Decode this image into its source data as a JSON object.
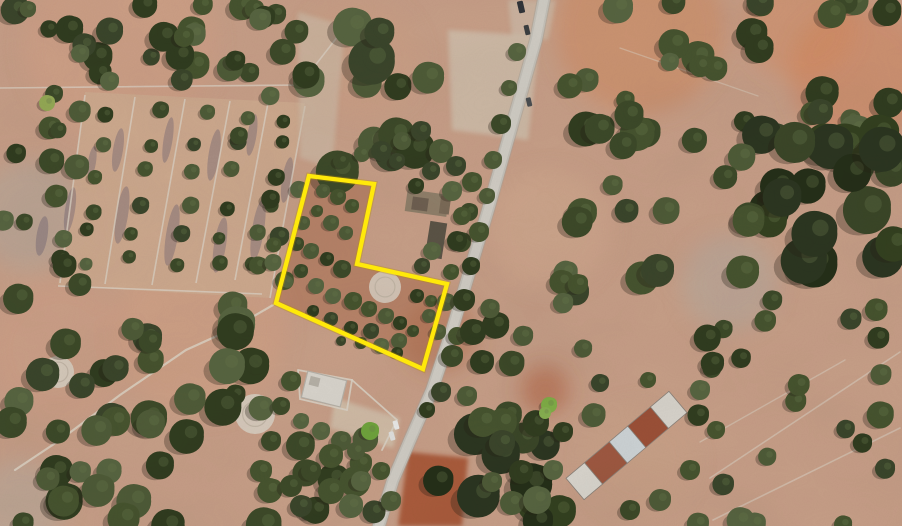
{
  "canvas": {
    "width": 902,
    "height": 526
  },
  "background": {
    "base": "#c79e87"
  },
  "seed": 1337,
  "noise": {
    "grain_opacity": 0.08,
    "mottle_opacity": 0.12
  },
  "soft_patches": [
    {
      "x": 640,
      "y": 30,
      "r": 85,
      "color": "#d08457",
      "opacity": 0.45
    },
    {
      "x": 860,
      "y": 75,
      "r": 70,
      "color": "#d2825a",
      "opacity": 0.5
    },
    {
      "x": 800,
      "y": 25,
      "r": 55,
      "color": "#d68a5e",
      "opacity": 0.45
    },
    {
      "x": 120,
      "y": 45,
      "r": 95,
      "color": "#d6a184",
      "opacity": 0.4
    },
    {
      "x": 200,
      "y": 330,
      "r": 85,
      "color": "#d8a183",
      "opacity": 0.4
    },
    {
      "x": 60,
      "y": 350,
      "r": 70,
      "color": "#d3a088",
      "opacity": 0.35
    },
    {
      "x": 30,
      "y": 215,
      "r": 55,
      "color": "#b0a79d",
      "opacity": 0.5
    },
    {
      "x": 730,
      "y": 283,
      "r": 48,
      "color": "#b3a89d",
      "opacity": 0.55
    },
    {
      "x": 550,
      "y": 230,
      "r": 60,
      "color": "#d3ac90",
      "opacity": 0.35
    },
    {
      "x": 440,
      "y": 335,
      "r": 38,
      "color": "#a9623f",
      "opacity": 0.4
    },
    {
      "x": 545,
      "y": 390,
      "r": 24,
      "color": "#b05a36",
      "opacity": 0.5
    },
    {
      "x": 20,
      "y": 505,
      "r": 45,
      "color": "#b4a99e",
      "opacity": 0.5
    },
    {
      "x": 640,
      "y": 460,
      "r": 55,
      "color": "#c9a184",
      "opacity": 0.4
    },
    {
      "x": 360,
      "y": 60,
      "r": 60,
      "color": "#cfa183",
      "opacity": 0.35
    }
  ],
  "flat_patches": [
    {
      "points": [
        [
          448,
          30
        ],
        [
          540,
          36
        ],
        [
          528,
          140
        ],
        [
          452,
          130
        ]
      ],
      "color": "#cfc0ad",
      "opacity": 0.75
    },
    {
      "points": [
        [
          298,
          12
        ],
        [
          345,
          26
        ],
        [
          332,
          168
        ],
        [
          300,
          158
        ]
      ],
      "color": "#ccbda9",
      "opacity": 0.6
    },
    {
      "points": [
        [
          408,
          452
        ],
        [
          468,
          458
        ],
        [
          462,
          526
        ],
        [
          398,
          526
        ]
      ],
      "color": "#a34f30",
      "opacity": 0.85
    },
    {
      "points": [
        [
          335,
          398
        ],
        [
          400,
          418
        ],
        [
          393,
          448
        ],
        [
          330,
          428
        ]
      ],
      "color": "#d2c2ad",
      "opacity": 0.8
    },
    {
      "points": [
        [
          508,
          0
        ],
        [
          556,
          0
        ],
        [
          548,
          40
        ],
        [
          512,
          36
        ]
      ],
      "color": "#cdbfae",
      "opacity": 0.6
    }
  ],
  "fields": {
    "quad": [
      [
        85,
        92
      ],
      [
        305,
        103
      ],
      [
        270,
        298
      ],
      [
        58,
        286
      ]
    ],
    "fill": "#cda98e",
    "fill_opacity": 0.9,
    "wall_color": "#dbd2c4",
    "wall_width": 1.6,
    "wall_opacity": 0.75,
    "walls": [
      [
        [
          85,
          95
        ],
        [
          60,
          283
        ]
      ],
      [
        [
          135,
          97
        ],
        [
          105,
          284
        ]
      ],
      [
        [
          185,
          99
        ],
        [
          152,
          285
        ]
      ],
      [
        [
          230,
          101
        ],
        [
          196,
          283
        ]
      ],
      [
        [
          268,
          103
        ],
        [
          235,
          280
        ]
      ],
      [
        [
          305,
          106
        ],
        [
          270,
          298
        ]
      ],
      [
        [
          58,
          286
        ],
        [
          262,
          294
        ]
      ]
    ],
    "streak_color": "#57506a",
    "streak_opacity": 0.32,
    "streak_angle": 9,
    "streaks": [
      [
        118,
        150,
        10,
        44
      ],
      [
        122,
        215,
        12,
        58
      ],
      [
        168,
        140,
        9,
        46
      ],
      [
        172,
        235,
        12,
        62
      ],
      [
        214,
        155,
        11,
        52
      ],
      [
        220,
        245,
        12,
        56
      ],
      [
        252,
        135,
        9,
        42
      ],
      [
        258,
        230,
        12,
        62
      ],
      [
        287,
        180,
        10,
        46
      ],
      [
        70,
        210,
        10,
        46
      ],
      [
        42,
        236,
        11,
        40
      ],
      [
        92,
        162,
        8,
        32
      ]
    ],
    "tree_rows": {
      "x_top": [
        110,
        160,
        207,
        249,
        287
      ],
      "x_bot": [
        82,
        128,
        174,
        215,
        253
      ],
      "y_top": 102,
      "y_bot": 278,
      "per_row": 6,
      "r_min": 6,
      "r_max": 9
    }
  },
  "lines": [
    {
      "points": [
        [
          0,
          88
        ],
        [
          300,
          85
        ],
        [
          345,
          27
        ]
      ],
      "color": "#dbd2c4",
      "width": 1.6,
      "opacity": 0.7
    },
    {
      "points": [
        [
          273,
          305
        ],
        [
          230,
          330
        ],
        [
          186,
          350
        ],
        [
          120,
          395
        ],
        [
          60,
          440
        ],
        [
          15,
          470
        ]
      ],
      "color": "#ddd4c6",
      "width": 2.2,
      "opacity": 0.8
    },
    {
      "points": [
        [
          532,
          36
        ],
        [
          505,
          150
        ],
        [
          480,
          240
        ],
        [
          455,
          330
        ],
        [
          437,
          380
        ]
      ],
      "color": "#eae4d8",
      "width": 1.8,
      "opacity": 0.7
    },
    {
      "points": [
        [
          710,
          478
        ],
        [
          900,
          352
        ]
      ],
      "color": "#d7ccbc",
      "width": 1.6,
      "opacity": 0.6
    },
    {
      "points": [
        [
          700,
          442
        ],
        [
          845,
          360
        ]
      ],
      "color": "#d7ccbc",
      "width": 1.4,
      "opacity": 0.55
    },
    {
      "points": [
        [
          713,
          520
        ],
        [
          900,
          428
        ]
      ],
      "color": "#d7ccbc",
      "width": 1.6,
      "opacity": 0.6
    },
    {
      "points": [
        [
          620,
          48
        ],
        [
          758,
          96
        ]
      ],
      "color": "#d7ccbc",
      "width": 1.3,
      "opacity": 0.5
    },
    {
      "points": [
        [
          352,
          380
        ],
        [
          397,
          420
        ],
        [
          382,
          450
        ]
      ],
      "color": "#d9d2c6",
      "width": 1.8,
      "opacity": 0.85
    },
    {
      "points": [
        [
          298,
          370
        ],
        [
          352,
          380
        ],
        [
          347,
          410
        ],
        [
          300,
          399
        ],
        [
          298,
          370
        ]
      ],
      "color": "#d9d2c6",
      "width": 1.8,
      "opacity": 0.85
    }
  ],
  "road": {
    "points": [
      [
        545,
        -6
      ],
      [
        536,
        40
      ],
      [
        522,
        90
      ],
      [
        505,
        150
      ],
      [
        488,
        210
      ],
      [
        470,
        270
      ],
      [
        452,
        330
      ],
      [
        432,
        390
      ],
      [
        410,
        440
      ],
      [
        393,
        480
      ],
      [
        377,
        532
      ]
    ],
    "layers": [
      {
        "width": 14,
        "color": "#a8a399",
        "opacity": 0.55
      },
      {
        "width": 12,
        "color": "#c3bfb7",
        "opacity": 1
      },
      {
        "width": 8.5,
        "color": "#d0ccc4",
        "opacity": 1
      }
    ]
  },
  "eras": {
    "fill": "#d8d0c3",
    "ring": "#bdb2a1",
    "opacity": 0.85,
    "items": [
      {
        "x": 58,
        "y": 372,
        "r": 16
      },
      {
        "x": 255,
        "y": 414,
        "r": 20
      },
      {
        "x": 385,
        "y": 287,
        "r": 16
      }
    ]
  },
  "buildings": {
    "ruins": [
      {
        "cx": 427,
        "cy": 203,
        "w": 42,
        "h": 22,
        "rot": 8,
        "color": "#8f7e69"
      },
      {
        "cx": 420,
        "cy": 204,
        "w": 16,
        "h": 13,
        "rot": 8,
        "color": "#6e5f50"
      },
      {
        "cx": 445,
        "cy": 205,
        "w": 10,
        "h": 18,
        "rot": 8,
        "color": "#7a6a57"
      },
      {
        "cx": 436,
        "cy": 240,
        "w": 17,
        "h": 36,
        "rot": 9,
        "color": "#5b5346"
      }
    ],
    "house": {
      "cx": 324,
      "cy": 389,
      "w": 40,
      "h": 27,
      "rot": 14,
      "color": "#d8d4cc",
      "edge": "#b5b0a6"
    },
    "warehouse": {
      "p1": [
        575,
        489
      ],
      "p2": [
        678,
        402
      ],
      "width": 28,
      "outline": "#8a8178",
      "segments": [
        {
          "t0": 0.0,
          "t1": 0.18,
          "color": "#d9d5cd"
        },
        {
          "t0": 0.18,
          "t1": 0.42,
          "color": "#9d5840"
        },
        {
          "t0": 0.42,
          "t1": 0.6,
          "color": "#ccd2d4"
        },
        {
          "t0": 0.6,
          "t1": 0.82,
          "color": "#9a4f36"
        },
        {
          "t0": 0.82,
          "t1": 1.0,
          "color": "#d6d2ca"
        }
      ]
    }
  },
  "cars": [
    {
      "x": 527,
      "y": 30,
      "w": 5,
      "h": 10,
      "rot": -13,
      "color": "#3a3d40"
    },
    {
      "x": 529,
      "y": 102,
      "w": 5,
      "h": 9,
      "rot": -13,
      "color": "#4a4d50"
    },
    {
      "x": 521,
      "y": 7,
      "w": 6,
      "h": 12,
      "rot": -13,
      "color": "#303338"
    },
    {
      "x": 396,
      "y": 425,
      "w": 5,
      "h": 9,
      "rot": -16,
      "color": "#e9e9e7"
    },
    {
      "x": 392,
      "y": 436,
      "w": 5,
      "h": 9,
      "rot": -16,
      "color": "#dfdfdd"
    }
  ],
  "trees": {
    "palette": [
      "#3c4928",
      "#46532e",
      "#303c1f",
      "#4e5b37",
      "#576440",
      "#3a452a"
    ],
    "dark_palette": [
      "#2b3520",
      "#33401f",
      "#242e18",
      "#3a4627"
    ],
    "highlight": "#6a7a4b",
    "explicit": [
      [
        323,
        191,
        7
      ],
      [
        338,
        197,
        8
      ],
      [
        352,
        206,
        7
      ],
      [
        317,
        211,
        6
      ],
      [
        303,
        223,
        7
      ],
      [
        331,
        223,
        8
      ],
      [
        346,
        233,
        7
      ],
      [
        297,
        244,
        7
      ],
      [
        311,
        251,
        8
      ],
      [
        327,
        259,
        7
      ],
      [
        342,
        269,
        9
      ],
      [
        301,
        271,
        7
      ],
      [
        287,
        282,
        6
      ],
      [
        316,
        286,
        8
      ],
      [
        333,
        296,
        8
      ],
      [
        353,
        301,
        9
      ],
      [
        369,
        309,
        8
      ],
      [
        386,
        316,
        8
      ],
      [
        400,
        323,
        7
      ],
      [
        371,
        331,
        8
      ],
      [
        351,
        328,
        7
      ],
      [
        331,
        319,
        7
      ],
      [
        313,
        311,
        6
      ],
      [
        399,
        341,
        8
      ],
      [
        413,
        331,
        6
      ],
      [
        381,
        346,
        8
      ],
      [
        361,
        343,
        6
      ],
      [
        341,
        341,
        5
      ],
      [
        397,
        353,
        6
      ],
      [
        417,
        296,
        7
      ],
      [
        431,
        301,
        6
      ],
      [
        429,
        316,
        7
      ],
      [
        472,
        182,
        10
      ],
      [
        469,
        212,
        9
      ],
      [
        461,
        242,
        10
      ],
      [
        451,
        272,
        8
      ],
      [
        446,
        302,
        9
      ],
      [
        438,
        332,
        8
      ],
      [
        452,
        356,
        11
      ],
      [
        441,
        392,
        10
      ],
      [
        427,
        410,
        8
      ],
      [
        517,
        52,
        9
      ],
      [
        509,
        88,
        8
      ],
      [
        501,
        124,
        10
      ],
      [
        493,
        160,
        9
      ],
      [
        487,
        196,
        8
      ],
      [
        479,
        232,
        10
      ],
      [
        471,
        266,
        9
      ],
      [
        464,
        300,
        11
      ],
      [
        457,
        336,
        9
      ],
      [
        473,
        332,
        13
      ],
      [
        482,
        362,
        12
      ],
      [
        467,
        396,
        10
      ],
      [
        483,
        422,
        15
      ],
      [
        502,
        443,
        13
      ],
      [
        521,
        472,
        12
      ],
      [
        492,
        482,
        10
      ],
      [
        512,
        503,
        12
      ],
      [
        537,
        500,
        14
      ],
      [
        553,
        470,
        10
      ],
      [
        362,
        154,
        8
      ],
      [
        381,
        151,
        10
      ],
      [
        397,
        161,
        8
      ],
      [
        402,
        141,
        9
      ],
      [
        421,
        131,
        10
      ],
      [
        441,
        151,
        12
      ],
      [
        456,
        166,
        10
      ],
      [
        431,
        171,
        9
      ],
      [
        416,
        186,
        8
      ],
      [
        452,
        191,
        10
      ],
      [
        462,
        216,
        9
      ],
      [
        457,
        241,
        10
      ],
      [
        432,
        251,
        9
      ],
      [
        422,
        266,
        8
      ],
      [
        341,
        161,
        8
      ],
      [
        291,
        381,
        10
      ],
      [
        281,
        406,
        9
      ],
      [
        301,
        421,
        8
      ],
      [
        321,
        431,
        9
      ],
      [
        341,
        441,
        10
      ],
      [
        356,
        451,
        9
      ],
      [
        331,
        456,
        12
      ],
      [
        311,
        471,
        10
      ],
      [
        291,
        486,
        11
      ],
      [
        331,
        491,
        13
      ],
      [
        361,
        481,
        10
      ],
      [
        381,
        471,
        9
      ],
      [
        351,
        506,
        12
      ],
      [
        391,
        501,
        10
      ],
      [
        301,
        506,
        11
      ],
      [
        271,
        441,
        10
      ],
      [
        261,
        471,
        11
      ],
      [
        563,
        432,
        10
      ],
      [
        600,
        383,
        9
      ],
      [
        648,
        380,
        8
      ],
      [
        700,
        390,
        10
      ],
      [
        716,
        430,
        9
      ],
      [
        690,
        470,
        10
      ],
      [
        660,
        500,
        11
      ],
      [
        630,
        510,
        10
      ]
    ],
    "special": [
      [
        549,
        405,
        8,
        "#7fae46"
      ],
      [
        370,
        431,
        9,
        "#6fa33c"
      ],
      [
        47,
        103,
        8,
        "#93a854"
      ],
      [
        545,
        413,
        6,
        "#87b050"
      ]
    ],
    "regions": [
      {
        "x": 0,
        "y": 0,
        "w": 300,
        "h": 86,
        "count": 30,
        "rmin": 8,
        "rmax": 15
      },
      {
        "x": 300,
        "y": 0,
        "w": 150,
        "h": 172,
        "count": 13,
        "rmin": 13,
        "rmax": 25
      },
      {
        "x": 555,
        "y": 0,
        "w": 347,
        "h": 142,
        "count": 32,
        "rmin": 9,
        "rmax": 18
      },
      {
        "x": 756,
        "y": 128,
        "w": 146,
        "h": 140,
        "count": 22,
        "rmin": 13,
        "rmax": 24,
        "dark": true
      },
      {
        "x": 558,
        "y": 145,
        "w": 198,
        "h": 152,
        "count": 17,
        "rmin": 10,
        "rmax": 17
      },
      {
        "x": 0,
        "y": 88,
        "w": 82,
        "h": 205,
        "count": 14,
        "rmin": 8,
        "rmax": 13
      },
      {
        "x": 238,
        "y": 92,
        "w": 66,
        "h": 200,
        "count": 9,
        "rmin": 7,
        "rmax": 10
      },
      {
        "x": 0,
        "y": 296,
        "w": 272,
        "h": 230,
        "count": 42,
        "rmin": 10,
        "rmax": 19
      },
      {
        "x": 282,
        "y": 436,
        "w": 96,
        "h": 90,
        "count": 9,
        "rmin": 10,
        "rmax": 16
      },
      {
        "x": 430,
        "y": 428,
        "w": 132,
        "h": 98,
        "count": 10,
        "rmin": 13,
        "rmax": 22,
        "dark": true
      },
      {
        "x": 695,
        "y": 295,
        "w": 207,
        "h": 231,
        "count": 24,
        "rmin": 9,
        "rmax": 14
      },
      {
        "x": 478,
        "y": 300,
        "w": 118,
        "h": 124,
        "count": 10,
        "rmin": 9,
        "rmax": 15
      }
    ]
  },
  "parcel": {
    "points": [
      [
        309,
        176
      ],
      [
        374,
        184
      ],
      [
        357,
        264
      ],
      [
        447,
        284
      ],
      [
        423,
        369
      ],
      [
        276,
        303
      ]
    ],
    "fill": "#a8684a",
    "fill_opacity": 0.5,
    "stroke": "#ffe90a",
    "stroke_width": 4.3,
    "under_stroke": "#b98f06",
    "under_width": 6.5,
    "under_opacity": 0.35
  }
}
